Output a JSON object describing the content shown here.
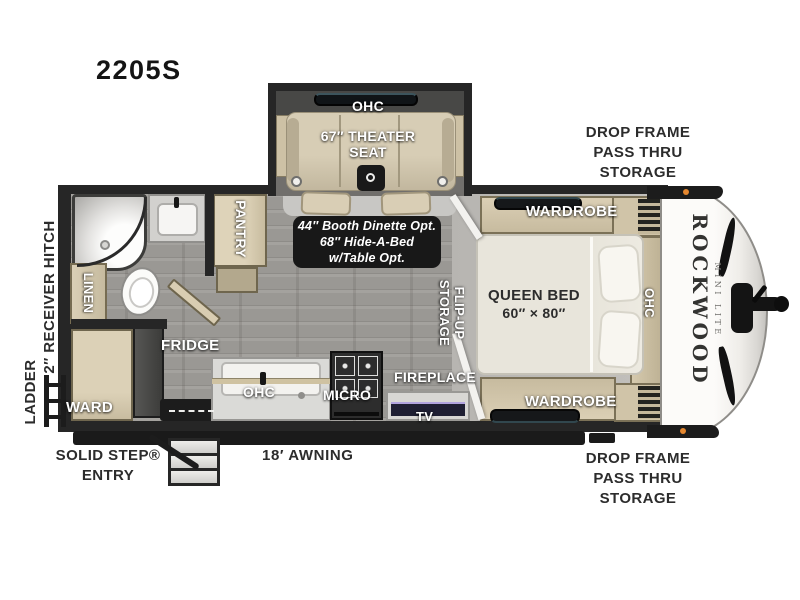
{
  "model": "2205S",
  "brand": {
    "name": "ROCKWOOD",
    "sub": "MINI LITE"
  },
  "exterior": {
    "receiver_hitch": "2″ RECEIVER HITCH",
    "ladder": "LADDER",
    "drop_frame_storage_top": "DROP FRAME\nPASS THRU\nSTORAGE",
    "drop_frame_storage_bottom": "DROP FRAME\nPASS THRU\nSTORAGE",
    "solid_step_entry": "SOLID STEP®\nENTRY",
    "awning": "18′ AWNING"
  },
  "slide_out": {
    "ohc": "OHC",
    "theater_seat": "67″ THEATER\nSEAT"
  },
  "bathroom": {
    "linen": "LINEN"
  },
  "kitchen": {
    "pantry": "PANTRY",
    "fridge": "FRIDGE",
    "wardrobe": "WARD",
    "ohc": "OHC",
    "micro": "MICRO",
    "fireplace": "FIREPLACE",
    "tv": "TV"
  },
  "dinette_option": "44″ Booth Dinette Opt.\n68″ Hide-A-Bed\nw/Table Opt.",
  "bedroom": {
    "wardrobe_top": "WARDROBE",
    "wardrobe_bottom": "WARDROBE",
    "bed": "QUEEN BED",
    "bed_size": "60″ × 80″",
    "flip_up_storage": "FLIP-UP\nSTORAGE",
    "ohc": "OHC"
  },
  "colors": {
    "wall": "#262626",
    "floor": "#9a9894",
    "carpet": "#bcbab6",
    "cabinet": "#d5c9ae",
    "badge": "#181818",
    "marker_light": "#e5872f"
  }
}
